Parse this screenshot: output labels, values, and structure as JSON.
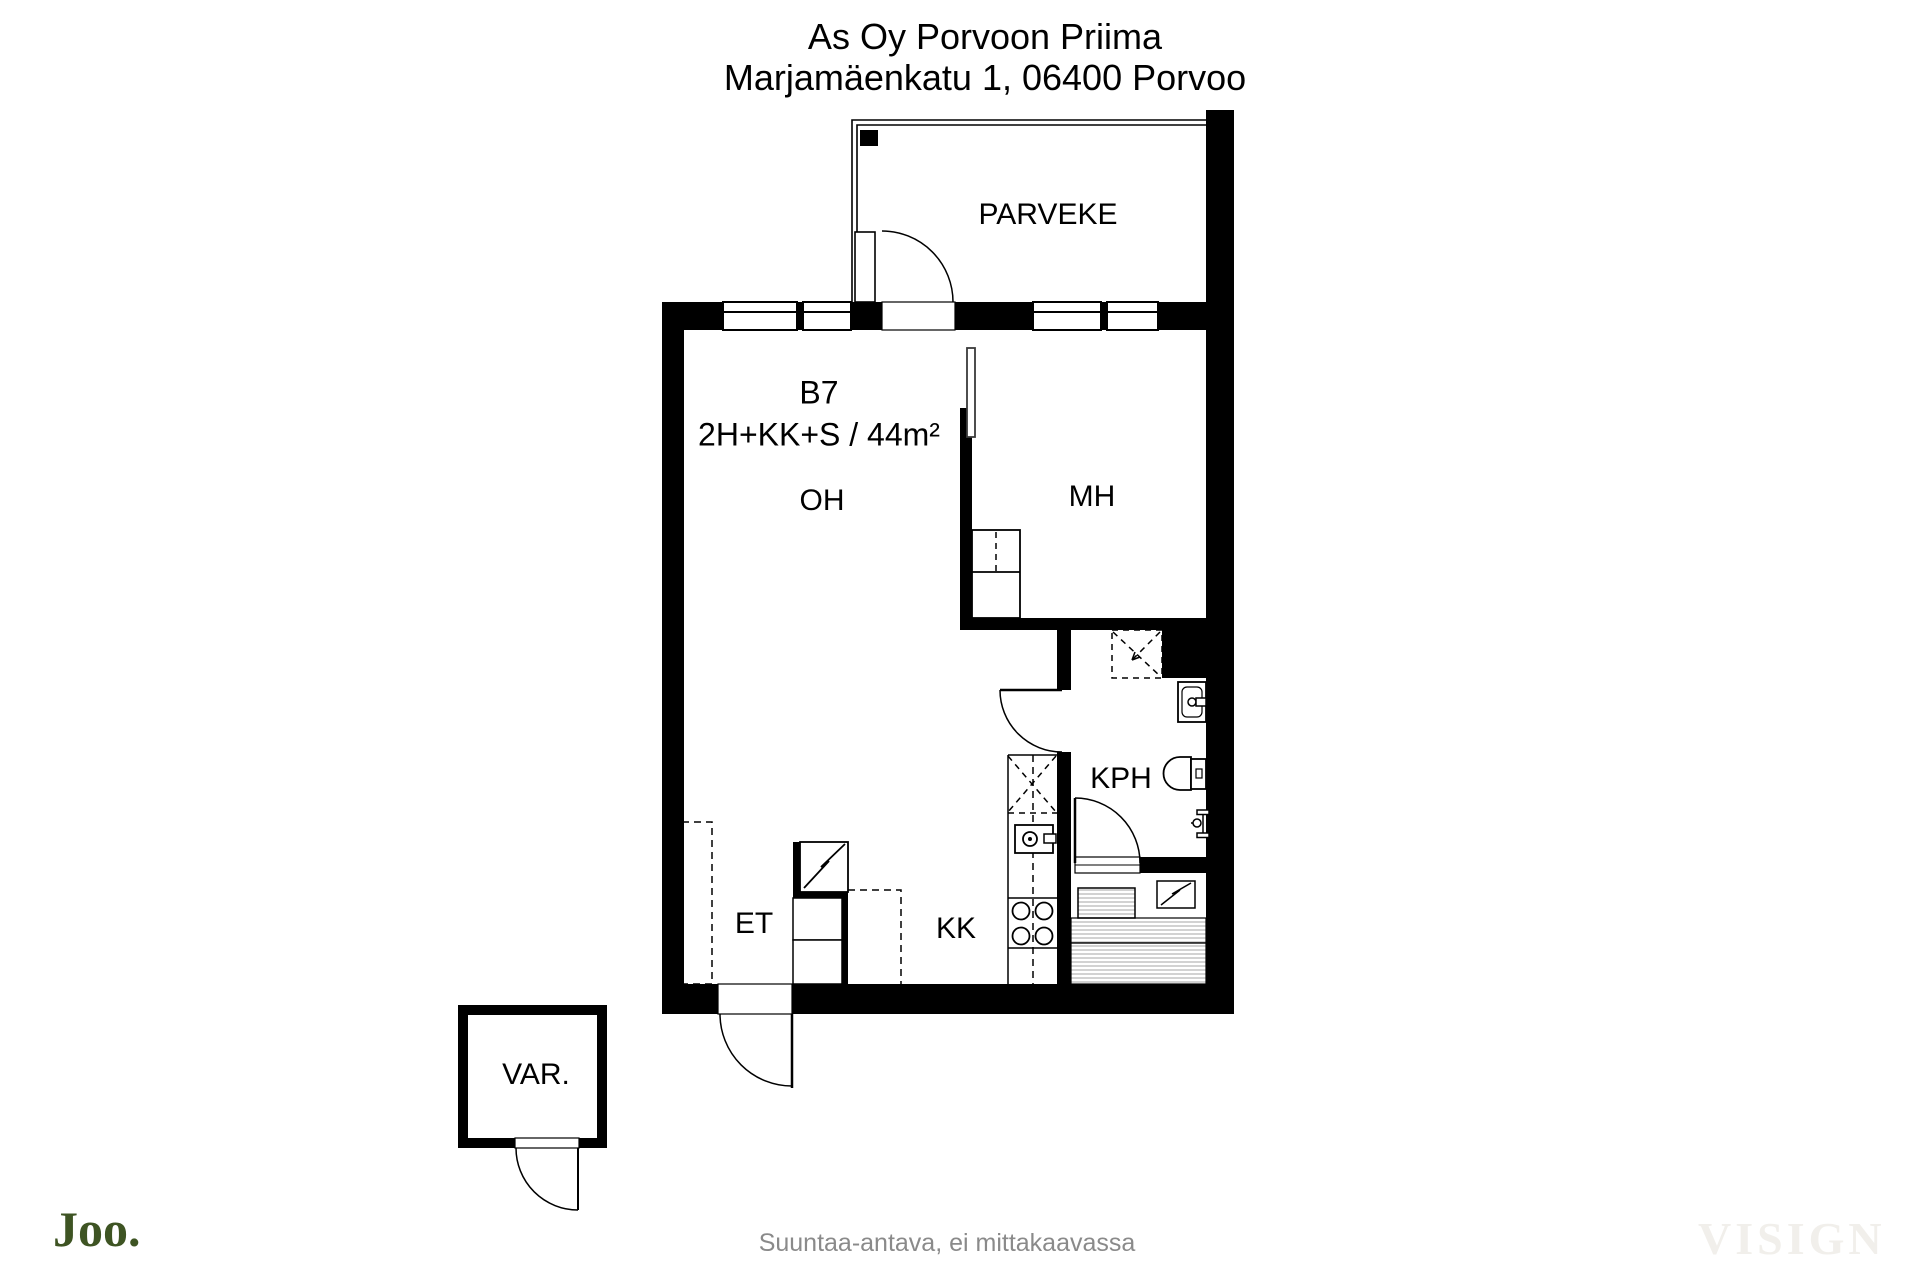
{
  "header": {
    "building": "As Oy Porvoon Priima",
    "address": "Marjamäenkatu 1, 06400 Porvoo"
  },
  "apartment": {
    "unit": "B7",
    "spec": "2H+KK+S / 44m²"
  },
  "rooms": {
    "balcony": "PARVEKE",
    "living": "OH",
    "bedroom": "MH",
    "bathroom": "KPH",
    "kitchenette": "KK",
    "entrance": "ET",
    "storage": "VAR."
  },
  "footer": {
    "logo": "Joo.",
    "disclaimer": "Suuntaa-antava, ei mittakaavassa",
    "watermark": "VISIGN"
  },
  "icons": {
    "electrical_appliance": "lightning-zigzag-in-box",
    "stove": "four-burner-circles",
    "sink": "square-with-tap-circle",
    "toilet": "bowl-and-tank",
    "washbasin": "basin-with-tap",
    "shower_reservation": "dashed-square-with-arrow",
    "door": "quarter-circle-swing"
  },
  "colors": {
    "logo_green": "#3e5423",
    "watermark": "#f1efeb",
    "disclaimer_gray": "#8a8a8a",
    "line": "#000000"
  }
}
